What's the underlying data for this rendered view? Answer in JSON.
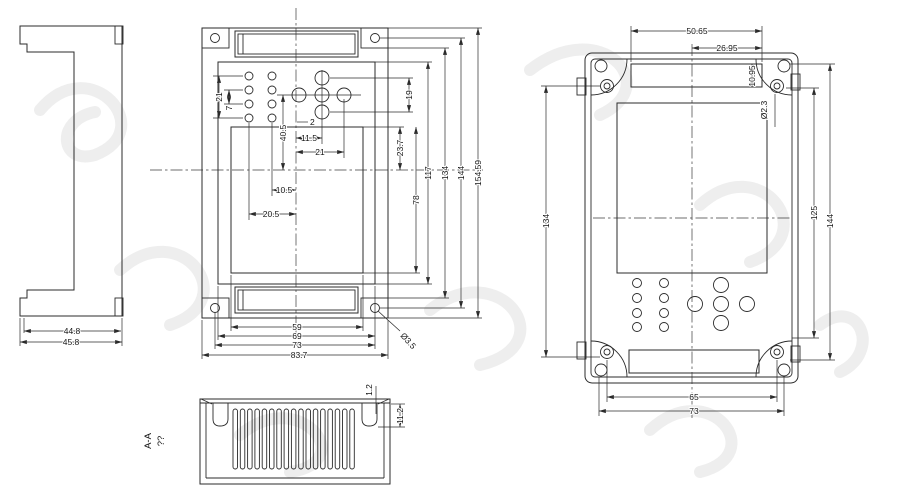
{
  "title": "enclosure-dimension-drawing",
  "colors": {
    "line": "#2b2b2b",
    "background": "#ffffff",
    "watermark": "#ebebeb"
  },
  "views": {
    "side": {
      "dims": {
        "inner_width": "44.8",
        "outer_width": "45.8"
      }
    },
    "front": {
      "dims": {
        "keypad_span": "21",
        "keypad_pitch": "7",
        "nav_drop": "40.5",
        "nav_col_mid": "11.5",
        "nav_col_right": "21",
        "nav_offset": "2",
        "keypad_col2": "10.5",
        "keypad_col1": "20.5",
        "nav_height": "19",
        "window_offset": "23.7",
        "window_height": "78",
        "panel_height": "117",
        "body_height": "134",
        "screw_pitch_v": "144",
        "overall_height": "154.59",
        "window_width": "59",
        "panel_width": "69",
        "screw_pitch_h": "73",
        "overall_width": "83.7",
        "screw_hole_dia": "Ø3.5"
      }
    },
    "section": {
      "label": "A-A",
      "label_note": "??",
      "dims": {
        "lip_thickness": "1.2",
        "boss_depth": "11.2"
      }
    },
    "rear": {
      "dims": {
        "slot_width": "50.65",
        "slot_center_offset": "26.95",
        "slot_height": "10.95",
        "screw_hole_dia": "Ø2.3",
        "body_height": "134",
        "screw_pitch_v": "144",
        "lid_height": "125",
        "screw_pitch_h": "65",
        "screw_pitch_h_outer": "73"
      }
    }
  }
}
